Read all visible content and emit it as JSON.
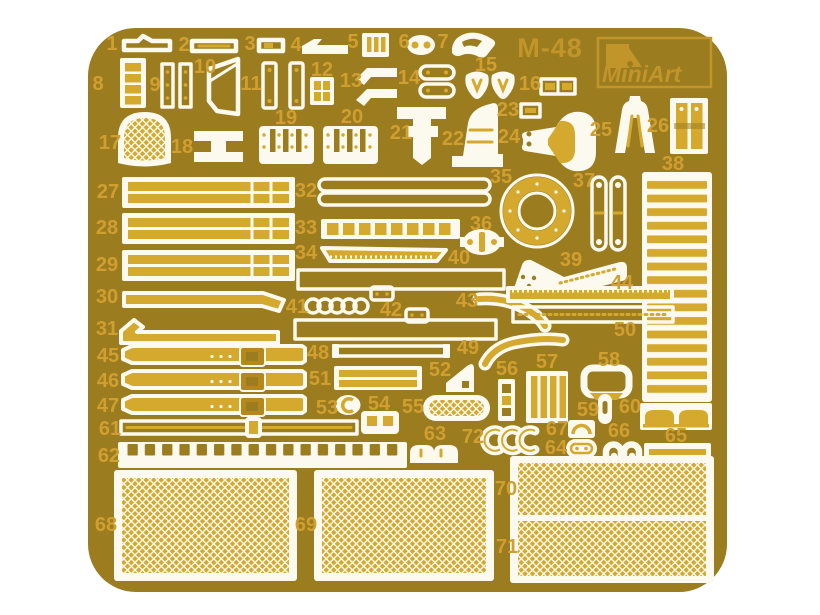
{
  "sheet": {
    "product_code": "M-48",
    "brand": "MiniArt",
    "colors": {
      "bg": "#ffffff",
      "base": "#9b7d20",
      "etch": "#fcfaef",
      "fill": "#d4a92e",
      "buckle": "#b6881c",
      "label": "#d19f30",
      "logo": "#c2952a"
    }
  },
  "parts": [
    {
      "num": "1",
      "x": 112,
      "y": 44
    },
    {
      "num": "2",
      "x": 184,
      "y": 45
    },
    {
      "num": "3",
      "x": 250,
      "y": 44
    },
    {
      "num": "4",
      "x": 296,
      "y": 45
    },
    {
      "num": "5",
      "x": 353,
      "y": 42
    },
    {
      "num": "6",
      "x": 404,
      "y": 42
    },
    {
      "num": "7",
      "x": 443,
      "y": 42
    },
    {
      "num": "8",
      "x": 98,
      "y": 84
    },
    {
      "num": "9",
      "x": 155,
      "y": 85
    },
    {
      "num": "10",
      "x": 205,
      "y": 67
    },
    {
      "num": "11",
      "x": 251,
      "y": 84
    },
    {
      "num": "12",
      "x": 322,
      "y": 70
    },
    {
      "num": "13",
      "x": 351,
      "y": 81
    },
    {
      "num": "14",
      "x": 409,
      "y": 78
    },
    {
      "num": "15",
      "x": 486,
      "y": 65
    },
    {
      "num": "16",
      "x": 530,
      "y": 84
    },
    {
      "num": "17",
      "x": 110,
      "y": 143
    },
    {
      "num": "18",
      "x": 182,
      "y": 147
    },
    {
      "num": "19",
      "x": 286,
      "y": 118
    },
    {
      "num": "20",
      "x": 352,
      "y": 117
    },
    {
      "num": "21",
      "x": 401,
      "y": 133
    },
    {
      "num": "22",
      "x": 453,
      "y": 139
    },
    {
      "num": "23",
      "x": 508,
      "y": 110
    },
    {
      "num": "24",
      "x": 509,
      "y": 137
    },
    {
      "num": "25",
      "x": 601,
      "y": 130
    },
    {
      "num": "26",
      "x": 658,
      "y": 126
    },
    {
      "num": "27",
      "x": 108,
      "y": 192
    },
    {
      "num": "28",
      "x": 107,
      "y": 228
    },
    {
      "num": "29",
      "x": 107,
      "y": 265
    },
    {
      "num": "30",
      "x": 107,
      "y": 297
    },
    {
      "num": "31",
      "x": 107,
      "y": 329
    },
    {
      "num": "32",
      "x": 306,
      "y": 191
    },
    {
      "num": "33",
      "x": 306,
      "y": 228
    },
    {
      "num": "34",
      "x": 306,
      "y": 253
    },
    {
      "num": "35",
      "x": 501,
      "y": 177
    },
    {
      "num": "36",
      "x": 481,
      "y": 224
    },
    {
      "num": "37",
      "x": 584,
      "y": 181
    },
    {
      "num": "38",
      "x": 673,
      "y": 164
    },
    {
      "num": "39",
      "x": 571,
      "y": 260
    },
    {
      "num": "40",
      "x": 459,
      "y": 258
    },
    {
      "num": "41",
      "x": 297,
      "y": 307
    },
    {
      "num": "42",
      "x": 391,
      "y": 310
    },
    {
      "num": "43",
      "x": 467,
      "y": 301
    },
    {
      "num": "44",
      "x": 622,
      "y": 283
    },
    {
      "num": "45",
      "x": 108,
      "y": 356
    },
    {
      "num": "46",
      "x": 108,
      "y": 381
    },
    {
      "num": "47",
      "x": 108,
      "y": 406
    },
    {
      "num": "48",
      "x": 318,
      "y": 353
    },
    {
      "num": "49",
      "x": 468,
      "y": 348
    },
    {
      "num": "50",
      "x": 625,
      "y": 330
    },
    {
      "num": "51",
      "x": 320,
      "y": 379
    },
    {
      "num": "52",
      "x": 440,
      "y": 370
    },
    {
      "num": "53",
      "x": 327,
      "y": 408
    },
    {
      "num": "54",
      "x": 379,
      "y": 404
    },
    {
      "num": "55",
      "x": 413,
      "y": 407
    },
    {
      "num": "56",
      "x": 507,
      "y": 369
    },
    {
      "num": "57",
      "x": 547,
      "y": 362
    },
    {
      "num": "58",
      "x": 609,
      "y": 360
    },
    {
      "num": "59",
      "x": 588,
      "y": 410
    },
    {
      "num": "60",
      "x": 630,
      "y": 407
    },
    {
      "num": "61",
      "x": 110,
      "y": 429
    },
    {
      "num": "62",
      "x": 109,
      "y": 456
    },
    {
      "num": "63",
      "x": 435,
      "y": 434
    },
    {
      "num": "64",
      "x": 556,
      "y": 448
    },
    {
      "num": "65",
      "x": 676,
      "y": 436
    },
    {
      "num": "66",
      "x": 619,
      "y": 431
    },
    {
      "num": "67",
      "x": 557,
      "y": 429
    },
    {
      "num": "68",
      "x": 106,
      "y": 525
    },
    {
      "num": "69",
      "x": 306,
      "y": 525
    },
    {
      "num": "70",
      "x": 506,
      "y": 489
    },
    {
      "num": "71",
      "x": 507,
      "y": 547
    },
    {
      "num": "72",
      "x": 473,
      "y": 437
    }
  ]
}
